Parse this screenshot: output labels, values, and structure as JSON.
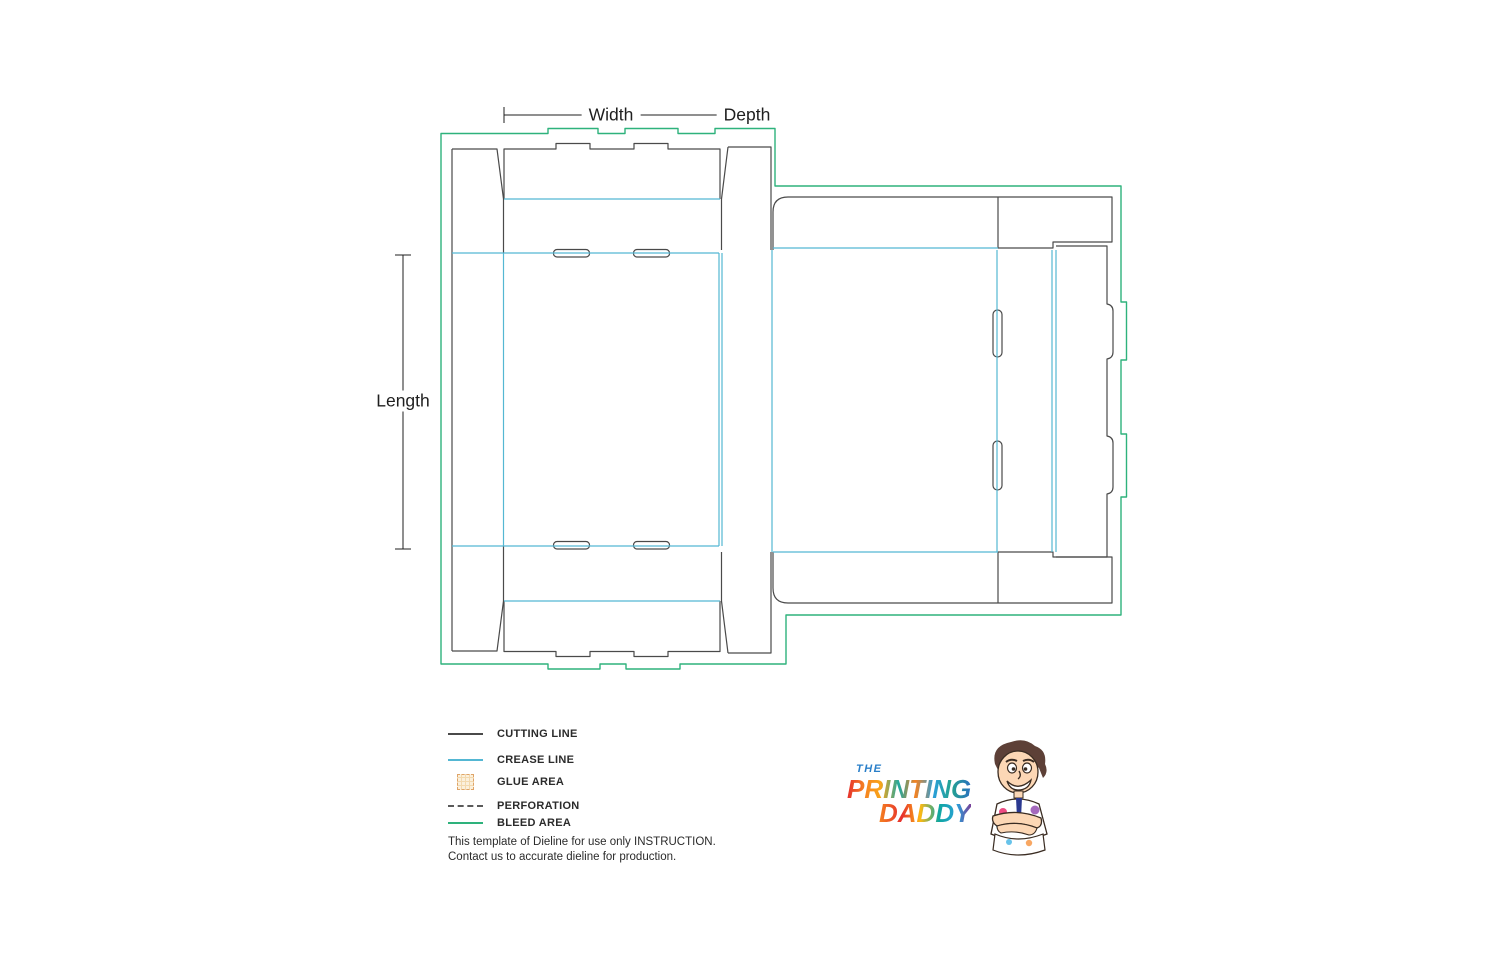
{
  "dimensions": {
    "width_label": "Width",
    "depth_label": "Depth",
    "length_label": "Length"
  },
  "legend": {
    "items": [
      {
        "key": "cutting-line",
        "label": "CUTTING LINE"
      },
      {
        "key": "crease-line",
        "label": "CREASE LINE"
      },
      {
        "key": "glue-area",
        "label": "GLUE AREA"
      },
      {
        "key": "perforation",
        "label": "PERFORATION"
      },
      {
        "key": "bleed-area",
        "label": "BLEED AREA"
      }
    ]
  },
  "note": {
    "line1": "This template of Dieline for use only INSTRUCTION.",
    "line2": "Contact us to accurate dieline for production."
  },
  "logo": {
    "the": "THE",
    "word1": "PRINTING",
    "word2": "DADDY"
  },
  "colors": {
    "cut_line": "#4a4a4a",
    "crease_line": "#54b7d3",
    "bleed_line": "#2eb27c",
    "glue_border": "#dfa468",
    "glue_fill": "#fbf0dc",
    "glue_grid": "#f3d9ae",
    "perforation": "#5a5a5a",
    "dimension_text": "#1f1f1f",
    "logo_the": "#2a7fc9"
  }
}
